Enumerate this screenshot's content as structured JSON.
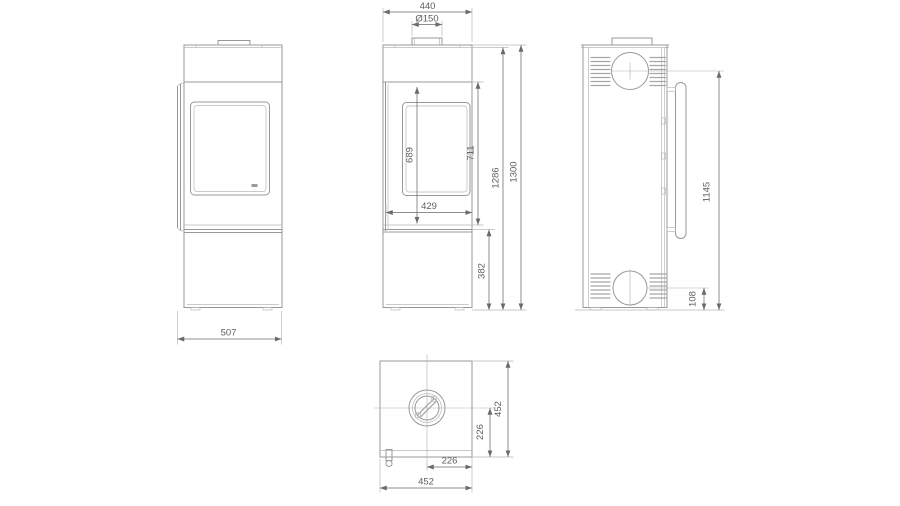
{
  "drawing": {
    "background": "#ffffff",
    "line_color": "#989898",
    "dimension_color": "#6a6a6a",
    "text_color": "#5e5e5e",
    "views": {
      "side": {
        "overall_width": "507"
      },
      "front": {
        "top_width": "440",
        "flue_diameter": "Ø150",
        "glass_height": "689",
        "door_height": "711",
        "glass_width": "429",
        "body_height": "1286",
        "total_height": "1300",
        "base_height": "382"
      },
      "rear": {
        "flue_center_height": "1145",
        "intake_center_height": "108"
      },
      "top": {
        "overall_width": "452",
        "overall_depth": "452",
        "flue_center_offset_width": "226",
        "flue_center_offset_depth": "226"
      }
    }
  }
}
